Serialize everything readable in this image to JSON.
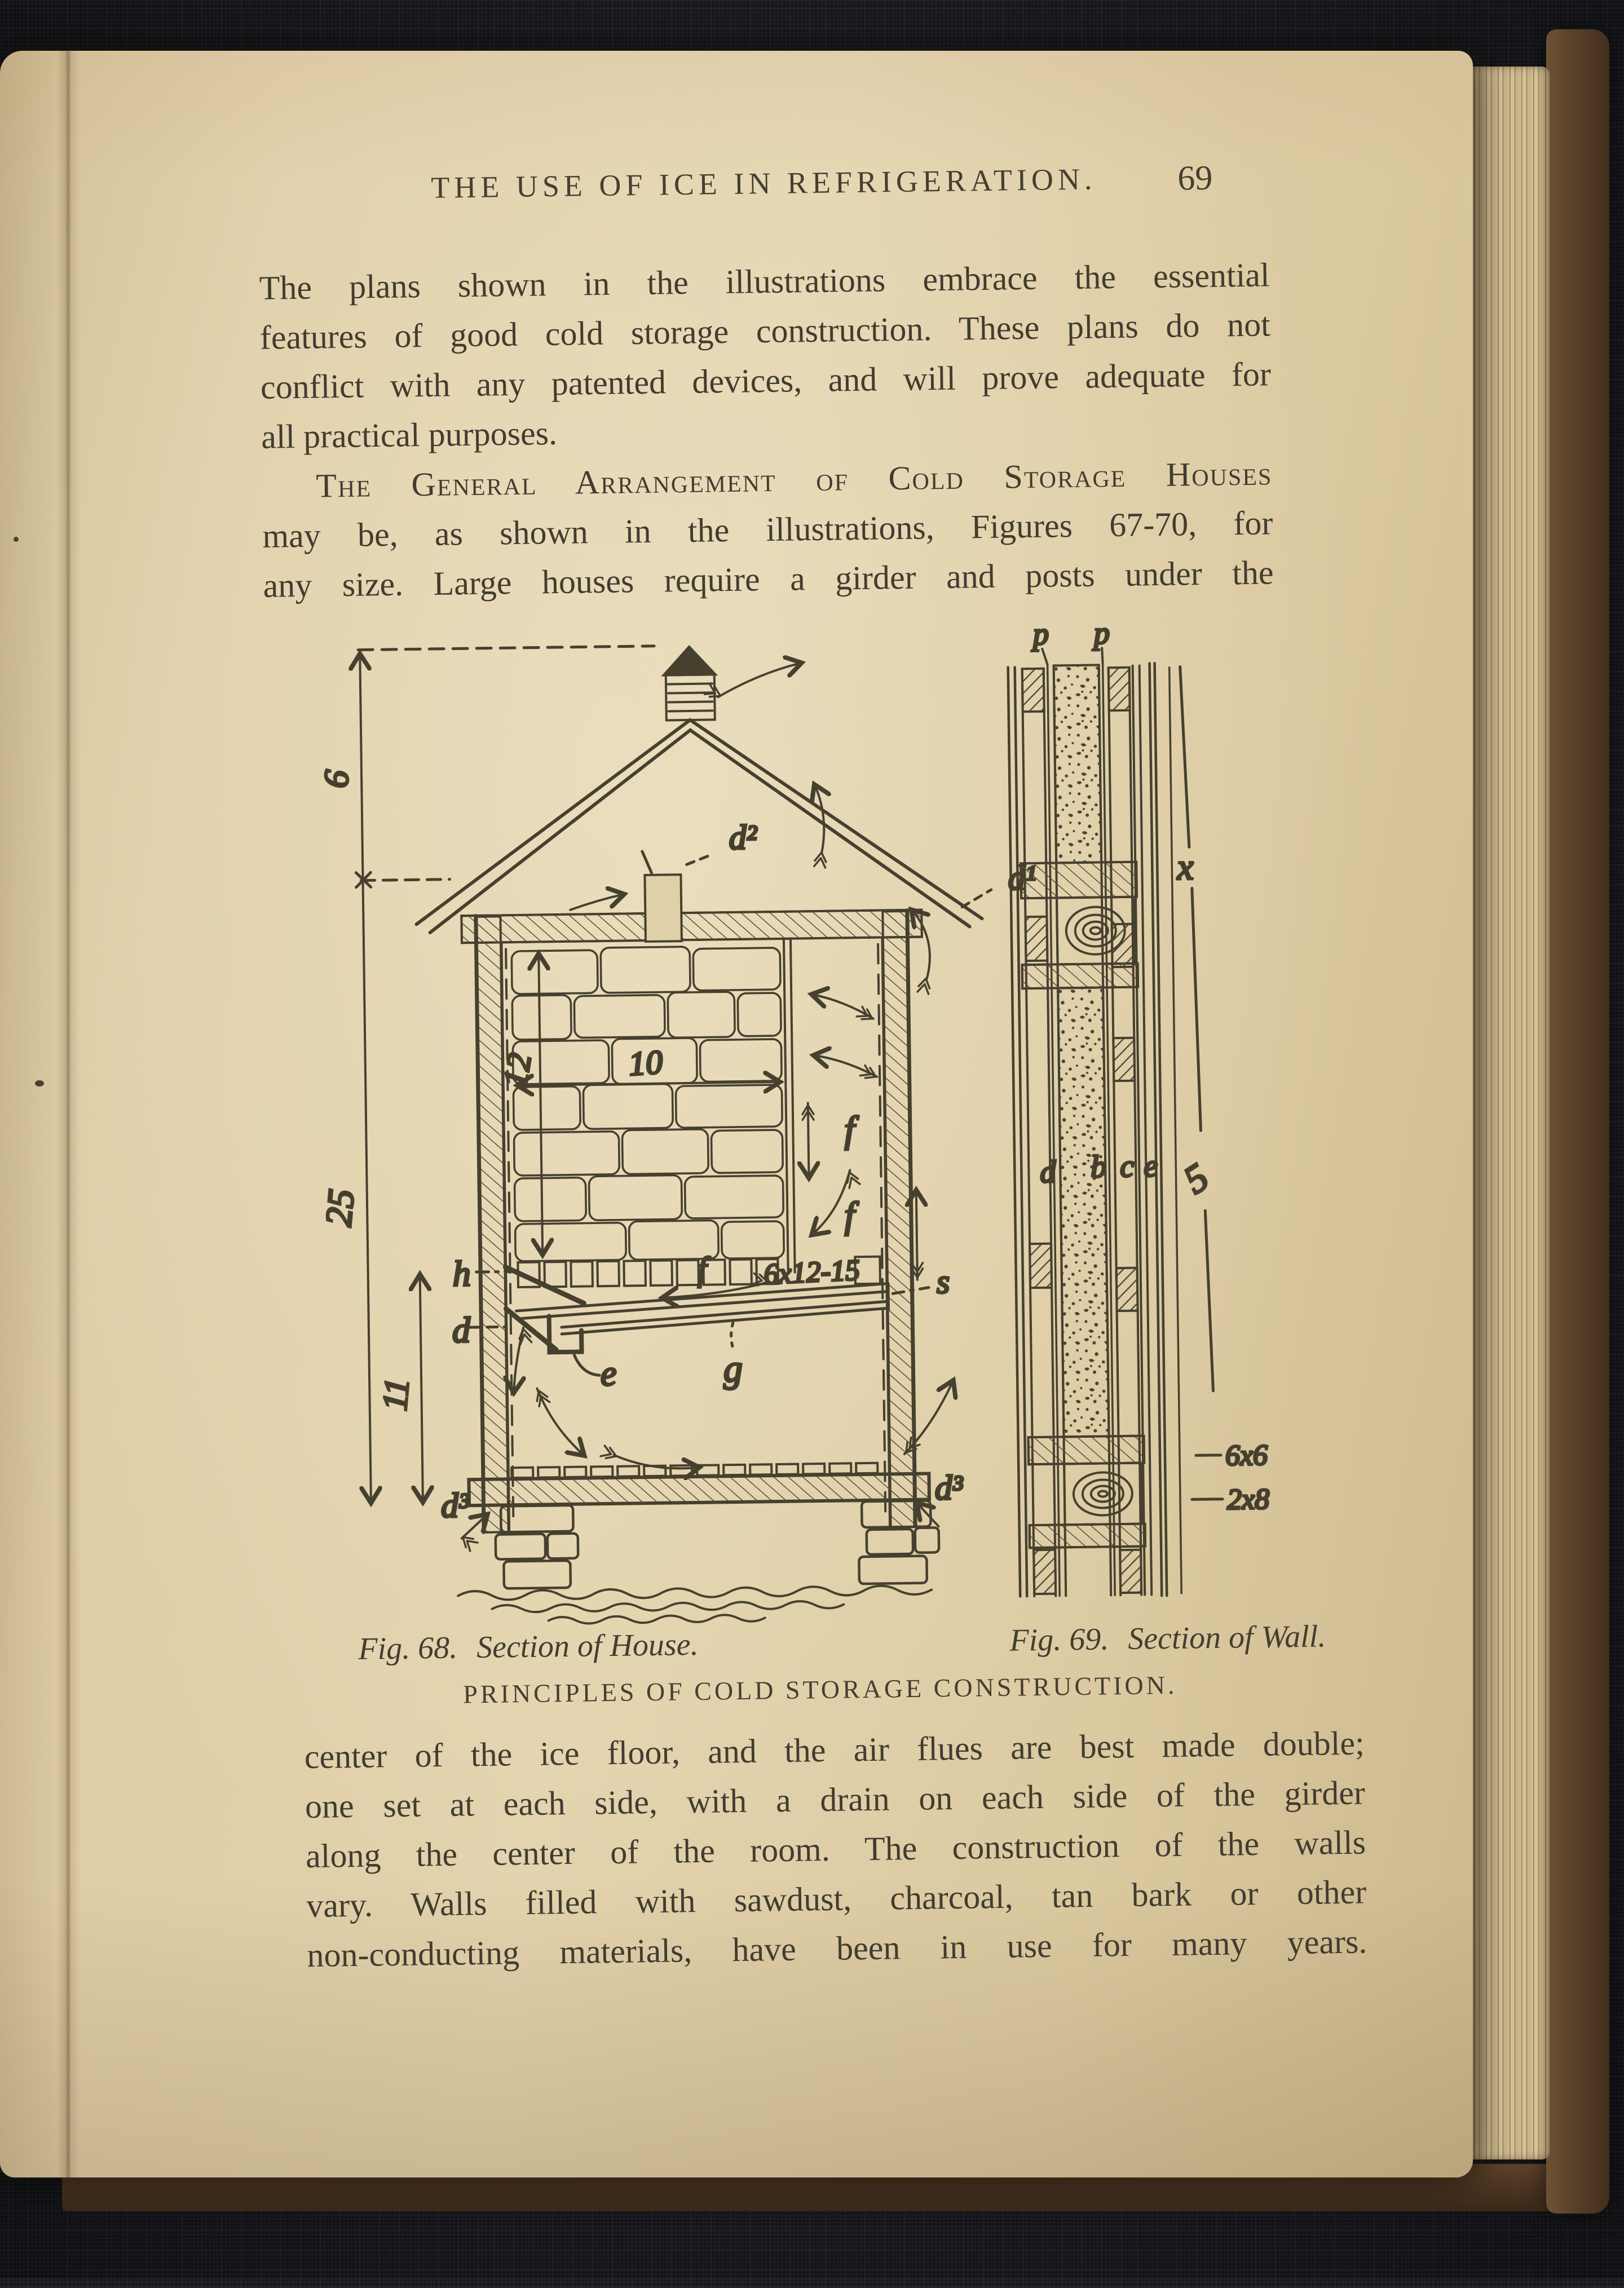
{
  "book": {
    "header": {
      "title": "THE USE OF ICE IN REFRIGERATION.",
      "page_number": "69"
    },
    "paragraphs": {
      "p1": [
        "The plans shown in the illustrations embrace the essential",
        "features of good cold storage construction.  These plans do not",
        "conflict with any patented devices, and will prove adequate for",
        "all practical purposes."
      ],
      "p2_smallcaps": "The General Arrangement of Cold Storage Houses",
      "p2": [
        "may be, as shown in the illustrations, Figures 67-70, for",
        "any size.  Large houses require a girder and posts under the"
      ],
      "p3": [
        "center of the ice floor, and the air flues are best made double;",
        "one set at each side, with a drain on each side of the girder",
        "along the center of the room.  The construction of the walls",
        "vary.  Walls filled with sawdust, charcoal, tan bark or other",
        "non-conducting materials, have been in use for many years."
      ]
    },
    "captions": {
      "fig68_label": "Fig. 68.",
      "fig68_title": "Section of House.",
      "fig69_label": "Fig. 69.",
      "fig69_title": "Section of Wall.",
      "subtitle": "PRINCIPLES OF COLD STORAGE CONSTRUCTION."
    },
    "figure": {
      "house": {
        "dim_roof": "6",
        "dim_height": "25",
        "dim_lower": "11",
        "dim_ice_h": "12",
        "dim_ice_w": "10",
        "vent_upper": "d²",
        "vent_eave": "d¹",
        "floor_line": "h",
        "drain_left": "d",
        "drain_cup": "e",
        "gutter": "g",
        "flue": "f",
        "sewer": "s",
        "base": "d³",
        "pan_size": "6x12-15"
      },
      "wall": {
        "paper": "p",
        "upper": "x",
        "lower": "5",
        "layer1": "d",
        "layer2": "b",
        "layer3": "c",
        "layer4": "e",
        "girt": "6x6",
        "plate": "2x8"
      }
    }
  }
}
